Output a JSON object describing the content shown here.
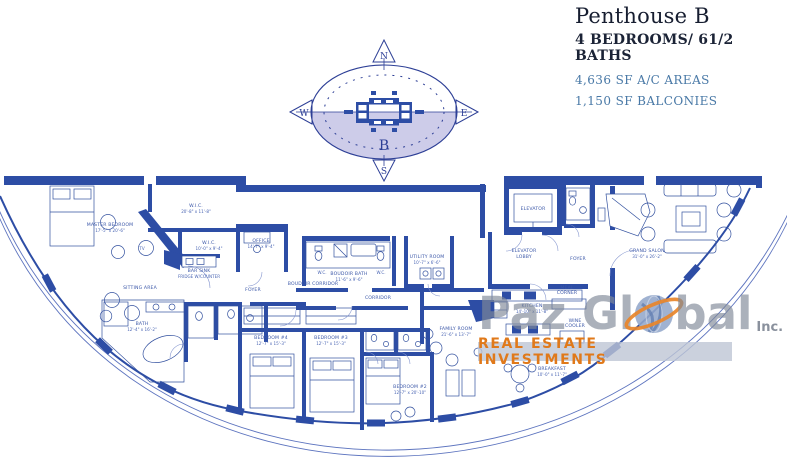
{
  "header": {
    "title": "Penthouse B",
    "subtitle": "4 BEDROOMS/ 61/2 BATHS",
    "stat_ac": "4,636 SF A/C AREAS",
    "stat_balconies": "1,150 SF BALCONIES"
  },
  "compass": {
    "north": "N",
    "south": "S",
    "east": "E",
    "west": "W",
    "unit": "B"
  },
  "watermark": {
    "name_left": "Paz Gl",
    "name_right": "bal",
    "suffix": "Inc.",
    "banner": "REAL ESTATE INVESTMENTS"
  },
  "colors": {
    "wall_navy": "#2d4da5",
    "line_blue": "#33519f",
    "lavender": "#cdcce9",
    "stat_blue": "#4878a6",
    "watermark_gray": "#828b99",
    "watermark_orange": "#e0791a"
  },
  "rooms": [
    {
      "label": "MASTER BEDROOM",
      "dims": "17'-5\" x 20'-6\""
    },
    {
      "label": "SITTING AREA",
      "dims": ""
    },
    {
      "label": "W.I.C.",
      "dims": "20'-8\" x 11'-8\""
    },
    {
      "label": "W.I.C.",
      "dims": "10'-0\" x 9'-4\""
    },
    {
      "label": "OFFICE",
      "dims": "14'-7\" x 9'-4\""
    },
    {
      "label": "BAR SINK",
      "dims": "FRIDGE W/COUNTER"
    },
    {
      "label": "FOYER",
      "dims": ""
    },
    {
      "label": "BOUDOIR CORRIDOR",
      "dims": ""
    },
    {
      "label": "BOUDOIR BATH",
      "dims": "11'-6\" x 9'-6\""
    },
    {
      "label": "UTILITY ROOM",
      "dims": "10'-7\" x 6'-6\""
    },
    {
      "label": "CORRIDOR",
      "dims": ""
    },
    {
      "label": "ELEVATOR",
      "dims": ""
    },
    {
      "label": "ELEVATOR",
      "dims": "LOBBY"
    },
    {
      "label": "FOYER",
      "dims": ""
    },
    {
      "label": "GRAND SALON",
      "dims": "31'-0\" x 26'-2\""
    },
    {
      "label": "MEAL",
      "dims": "CORNER"
    },
    {
      "label": "KITCHEN",
      "dims": "14'-10\" x 11'-8\""
    },
    {
      "label": "WINE",
      "dims": "COOLER"
    },
    {
      "label": "FAMILY ROOM",
      "dims": "21'-6\" x 13'-7\""
    },
    {
      "label": "BREAKFAST",
      "dims": "10'-0\" x 11'-7\""
    },
    {
      "label": "BEDROOM #4",
      "dims": "12'-7\" x 15'-3\""
    },
    {
      "label": "BEDROOM #3",
      "dims": "12'-7\" x 15'-3\""
    },
    {
      "label": "BEDROOM #2",
      "dims": "12'-7\" x 20'-10\""
    },
    {
      "label": "BATH",
      "dims": "12'-4\" x 16'-2\""
    },
    {
      "label": "W.C.",
      "dims": ""
    },
    {
      "label": "W.C.",
      "dims": ""
    },
    {
      "label": "TV",
      "dims": ""
    }
  ]
}
